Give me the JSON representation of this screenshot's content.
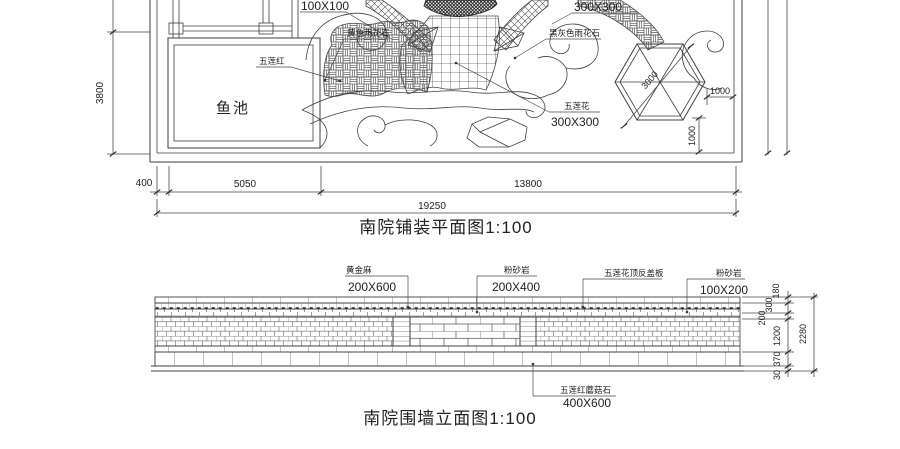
{
  "plan": {
    "title": "南院铺装平面图1:100",
    "pond_label": "鱼池",
    "labels": {
      "tile_100": "100X100",
      "yellow_stone": "黄色雨花石",
      "dark_stone": "黑灰色雨花石",
      "tile_300_tr": "300X300",
      "wulian_flower": "五莲花",
      "wulian_flower_size": "300X300",
      "wulian_red": "五莲红",
      "hex_dim": "3000",
      "dim_1000_h": "1000",
      "dim_1000_v": "1000"
    },
    "dims": {
      "left_height": "3800",
      "d400": "400",
      "d5050": "5050",
      "d13800": "13800",
      "total": "19250"
    }
  },
  "elevation": {
    "title": "南院围墙立面图1:100",
    "labels": {
      "gold_granite": "黄金麻",
      "gold_granite_size": "200X600",
      "sandstone_left": "粉砂岩",
      "sandstone_left_size": "200X400",
      "coping_board": "五莲花顶反盖板",
      "sandstone_right": "粉砂岩",
      "sandstone_right_size": "100X200",
      "mushroom_stone": "五莲红蘑菇石",
      "mushroom_stone_size": "400X600"
    },
    "dims": {
      "d180": "180",
      "d300": "300",
      "d200": "200",
      "d1200": "1200",
      "d370": "370",
      "d30": "30",
      "total": "2280"
    }
  },
  "colors": {
    "background": "#ffffff",
    "line": "#3f3f3f"
  }
}
